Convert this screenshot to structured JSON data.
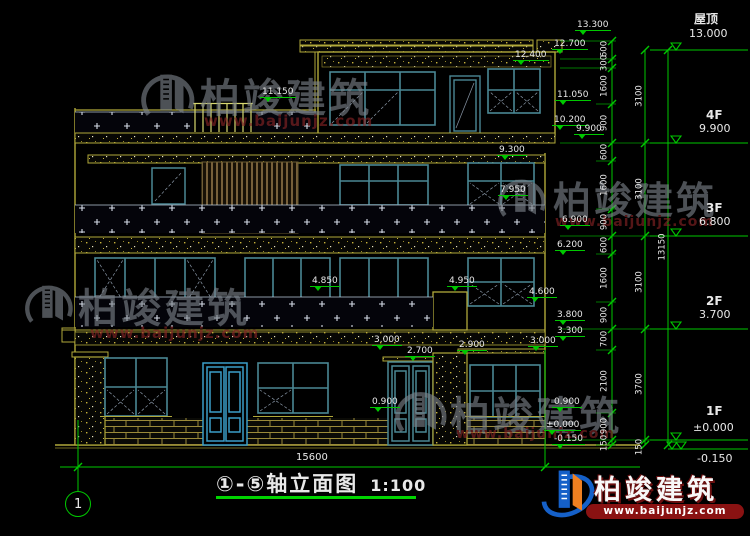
{
  "title": {
    "axis_range": "①-⑤轴立面图",
    "scale": "1:100"
  },
  "ground": {
    "overall_width": "15600"
  },
  "axis_bubbles": {
    "left": "1"
  },
  "right_column": {
    "floors": [
      {
        "name": "屋顶",
        "elev": "13.000"
      },
      {
        "name": "4F",
        "elev": "9.900"
      },
      {
        "name": "3F",
        "elev": "6.800"
      },
      {
        "name": "2F",
        "elev": "3.700"
      },
      {
        "name": "1F",
        "elev": "±0.000"
      }
    ],
    "base_elev": "-0.150",
    "total_height": "13150",
    "floor_heights": [
      "3100",
      "3100",
      "3100",
      "3700",
      "150"
    ],
    "segments": [
      "600",
      "300",
      "1600",
      "900",
      "600",
      "1600",
      "900",
      "600",
      "1600",
      "900",
      "700",
      "2100",
      "900",
      "150"
    ]
  },
  "elevations": [
    {
      "v": "13.300"
    },
    {
      "v": "12.700"
    },
    {
      "v": "12.400"
    },
    {
      "v": "11.150"
    },
    {
      "v": "11.050"
    },
    {
      "v": "10.200"
    },
    {
      "v": "9.900"
    },
    {
      "v": "9.300"
    },
    {
      "v": "7.950"
    },
    {
      "v": "6.900"
    },
    {
      "v": "6.200"
    },
    {
      "v": "4.850"
    },
    {
      "v": "4.950"
    },
    {
      "v": "4.600"
    },
    {
      "v": "3.800"
    },
    {
      "v": "3.300"
    },
    {
      "v": "3.000"
    },
    {
      "v": "2.900"
    },
    {
      "v": "3.000"
    },
    {
      "v": "2.700"
    },
    {
      "v": "0.900"
    },
    {
      "v": "0.900"
    },
    {
      "v": "±0.000"
    },
    {
      "v": "-0.150"
    }
  ],
  "watermark": {
    "brand": "柏竣建筑",
    "url": "www.baijunjz.com"
  },
  "colors": {
    "dimension_green": "#00c800",
    "wall_yellow": "#b0a83a",
    "window_teal": "#4a8794",
    "door_blue": "#3a9ec8",
    "text_white": "#e8e8e8",
    "logo_blue": "#1560c8",
    "logo_orange": "#f08020",
    "logo_red_band": "#8a1212",
    "background": "#000000"
  }
}
